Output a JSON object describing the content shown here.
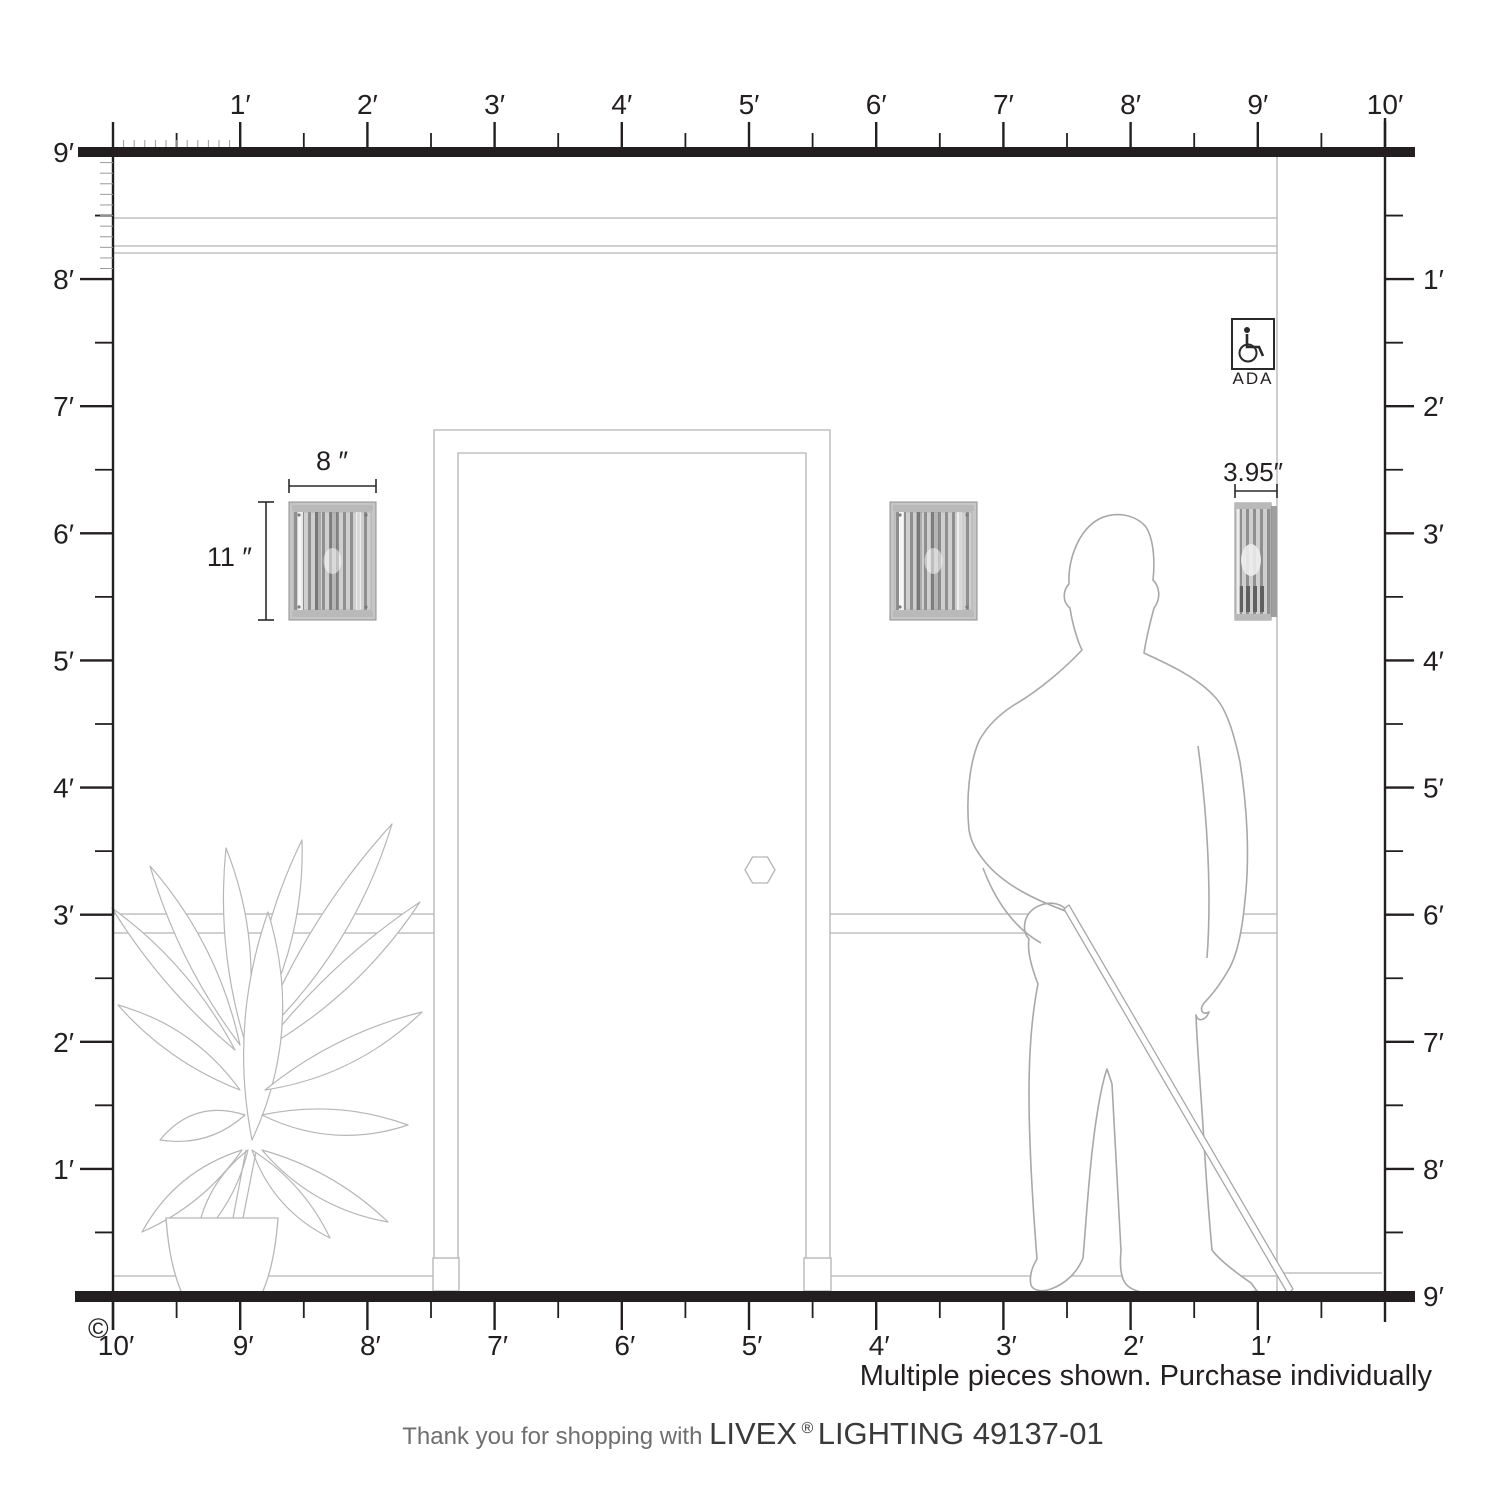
{
  "diagram": {
    "rulers": {
      "top": [
        "1′",
        "2′",
        "3′",
        "4′",
        "5′",
        "6′",
        "7′",
        "8′",
        "9′",
        "10′"
      ],
      "left": [
        "9′",
        "8′",
        "7′",
        "6′",
        "5′",
        "4′",
        "3′",
        "2′",
        "1′"
      ],
      "right": [
        "1′",
        "2′",
        "3′",
        "4′",
        "5′",
        "6′",
        "7′",
        "8′",
        "9′"
      ],
      "bottom": [
        "10′",
        "9′",
        "8′",
        "7′",
        "6′",
        "5′",
        "4′",
        "3′",
        "2′",
        "1′"
      ]
    },
    "fixture": {
      "width_label": "8 ″",
      "height_label": "11 ″",
      "depth_label": "3.95″"
    },
    "ada_label": "ADA",
    "footer": {
      "note": "Multiple pieces shown. Purchase individually",
      "thanks_prefix": "Thank you for shopping with ",
      "brand": "LIVEX",
      "registered": "®",
      "product": " LIGHTING 49137-01",
      "copyright": "©"
    },
    "colors": {
      "ink": "#231f20",
      "wall_line": "#b4b4b4",
      "figure_line": "#a8a8a8"
    }
  }
}
